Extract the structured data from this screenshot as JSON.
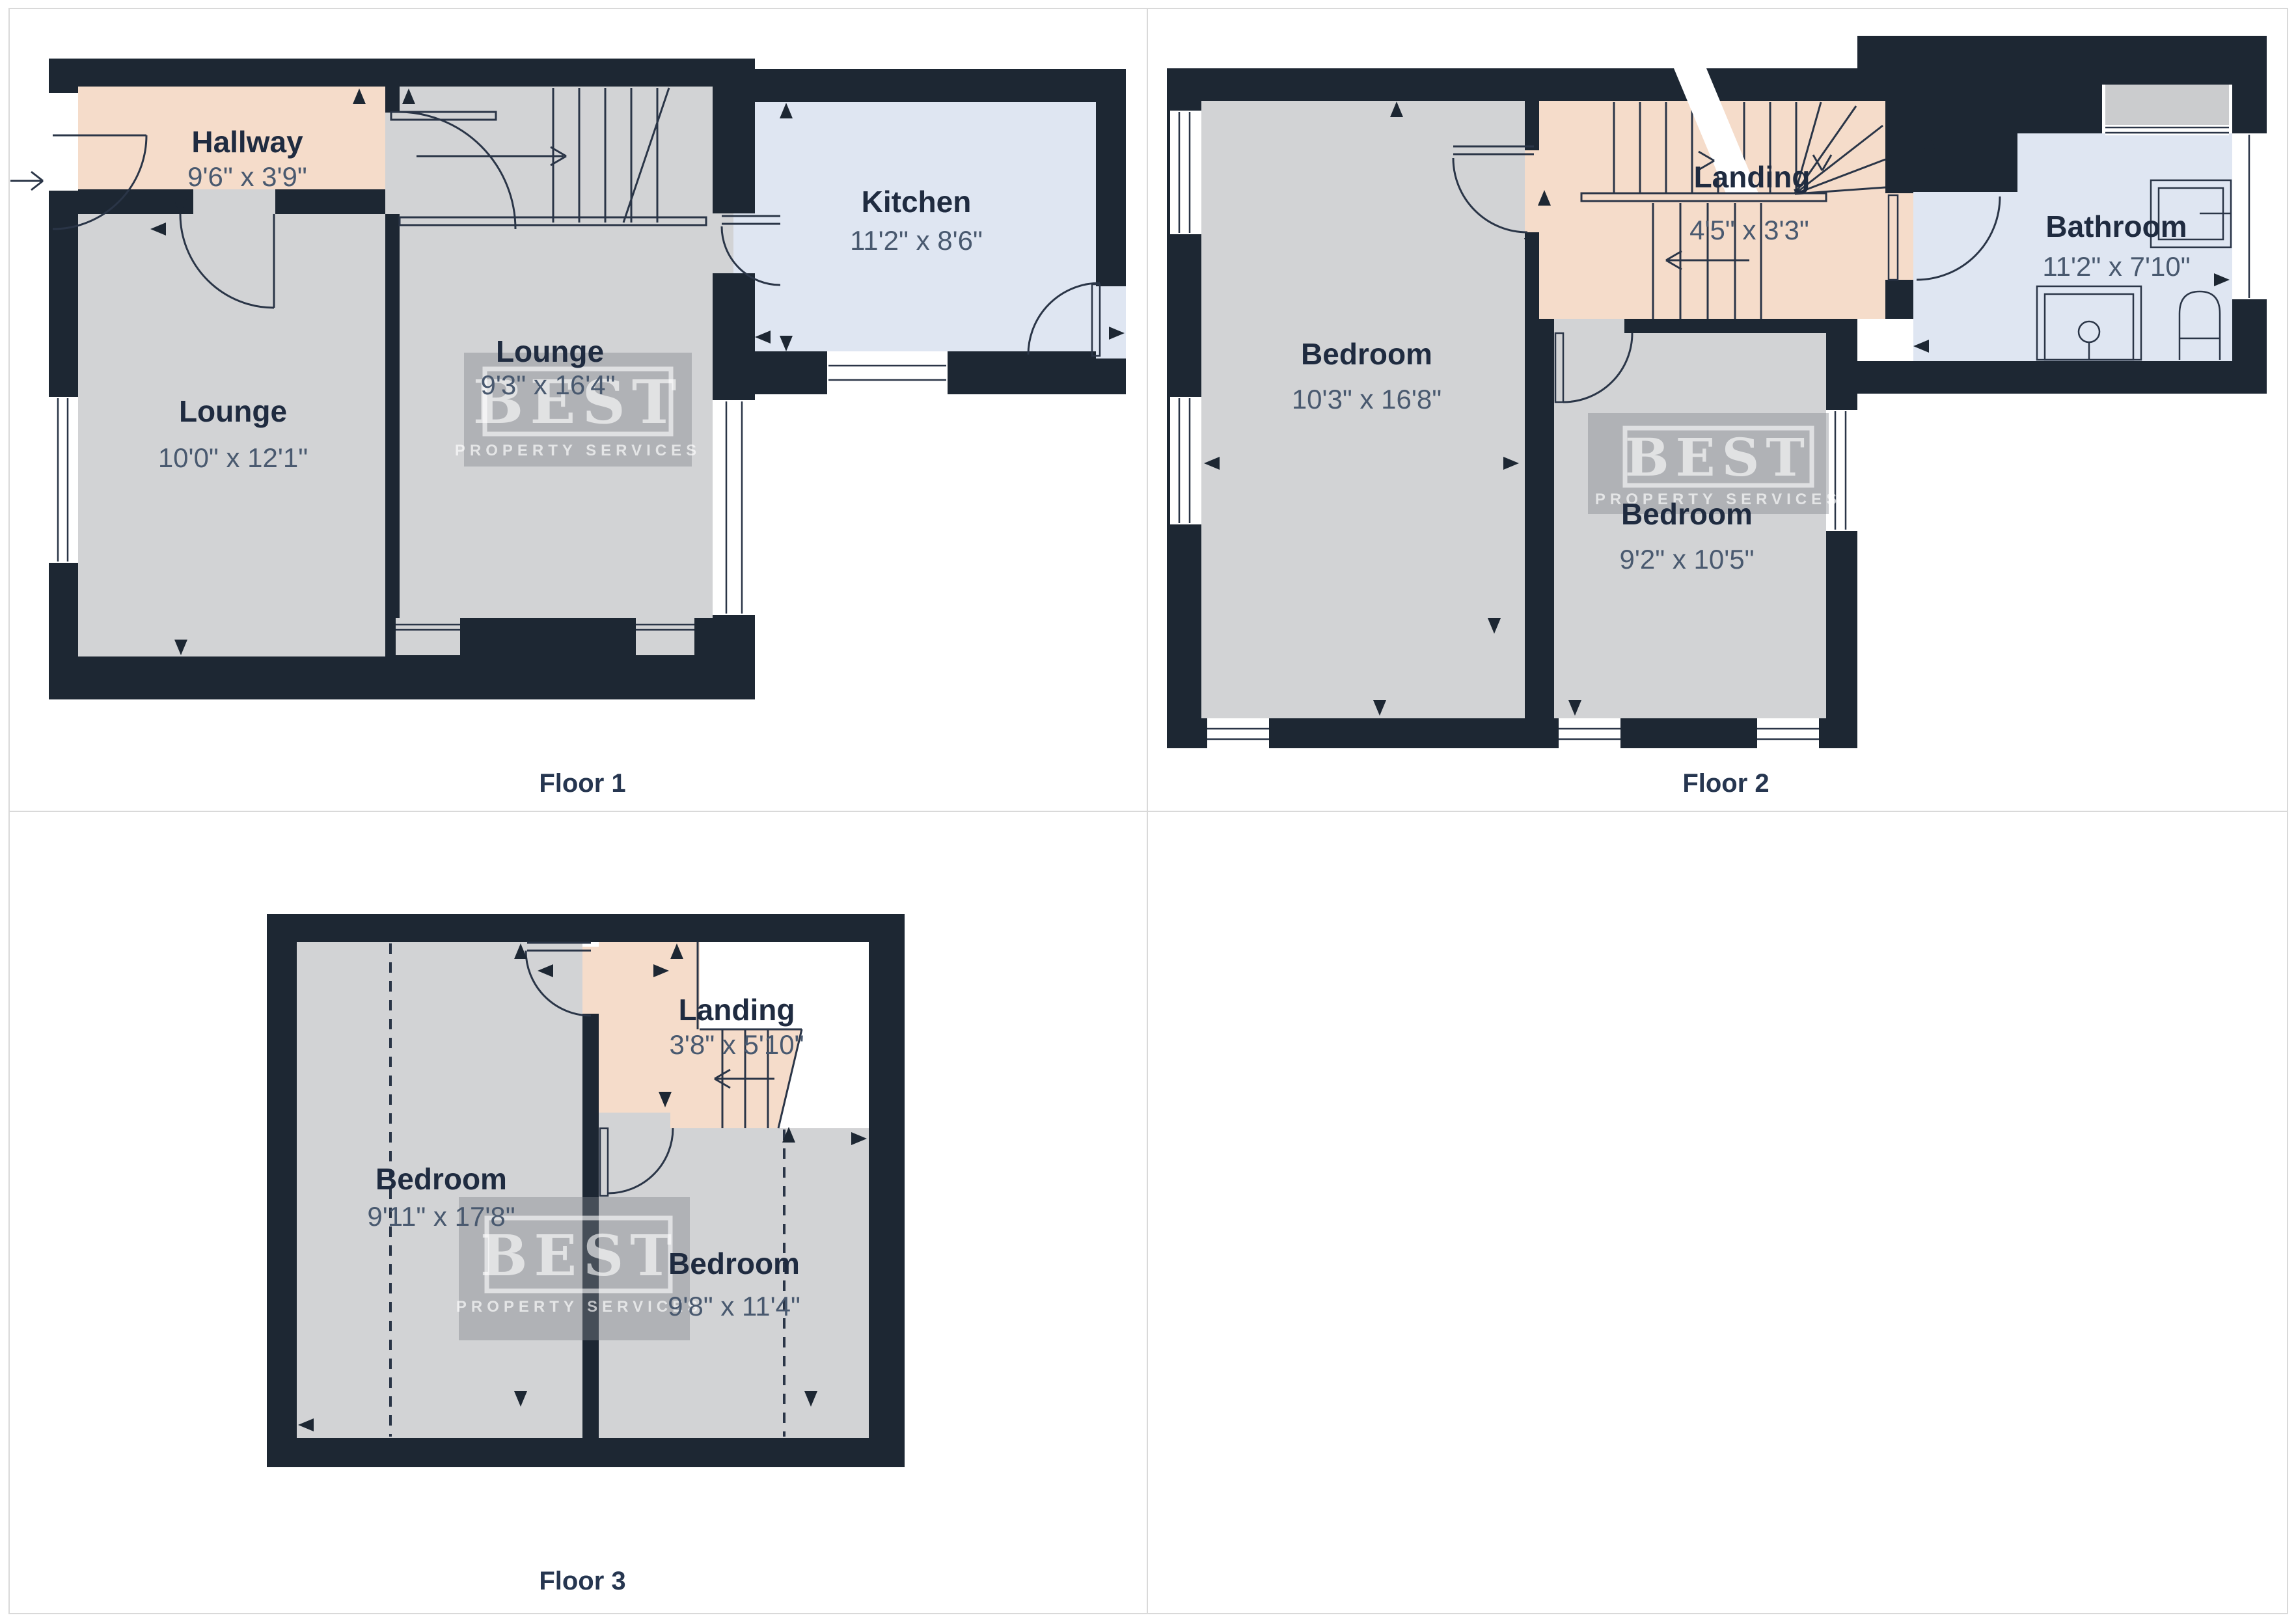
{
  "palette": {
    "wall": "#1d2733",
    "room_floor": "#d2d3d5",
    "hall_landing": "#f5dcca",
    "kitchen_bathroom": "#dfe6f2",
    "line": "#2a3547",
    "room_name_text": "#1f2b40",
    "dimension_text": "#49596f",
    "caption_text": "#263650"
  },
  "watermark": {
    "title": "BEST",
    "subtitle": "PROPERTY SERVICES"
  },
  "floors": [
    {
      "caption": "Floor 1",
      "rooms": [
        {
          "name": "Hallway",
          "dims": "9'6\" x 3'9\""
        },
        {
          "name": "Lounge",
          "dims": "10'0\" x 12'1\""
        },
        {
          "name": "Lounge",
          "dims": "9'3\" x 16'4\""
        },
        {
          "name": "Kitchen",
          "dims": "11'2\" x 8'6\""
        }
      ]
    },
    {
      "caption": "Floor 2",
      "rooms": [
        {
          "name": "Bedroom",
          "dims": "10'3\" x 16'8\""
        },
        {
          "name": "Landing",
          "dims": "4'5\" x 3'3\""
        },
        {
          "name": "Bedroom",
          "dims": "9'2\" x 10'5\""
        },
        {
          "name": "Bathroom",
          "dims": "11'2\" x 7'10\""
        }
      ]
    },
    {
      "caption": "Floor 3",
      "rooms": [
        {
          "name": "Bedroom",
          "dims": "9'11\" x 17'8\""
        },
        {
          "name": "Landing",
          "dims": "3'8\" x 5'10\""
        },
        {
          "name": "Bedroom",
          "dims": "9'8\" x 11'4\""
        }
      ]
    }
  ]
}
